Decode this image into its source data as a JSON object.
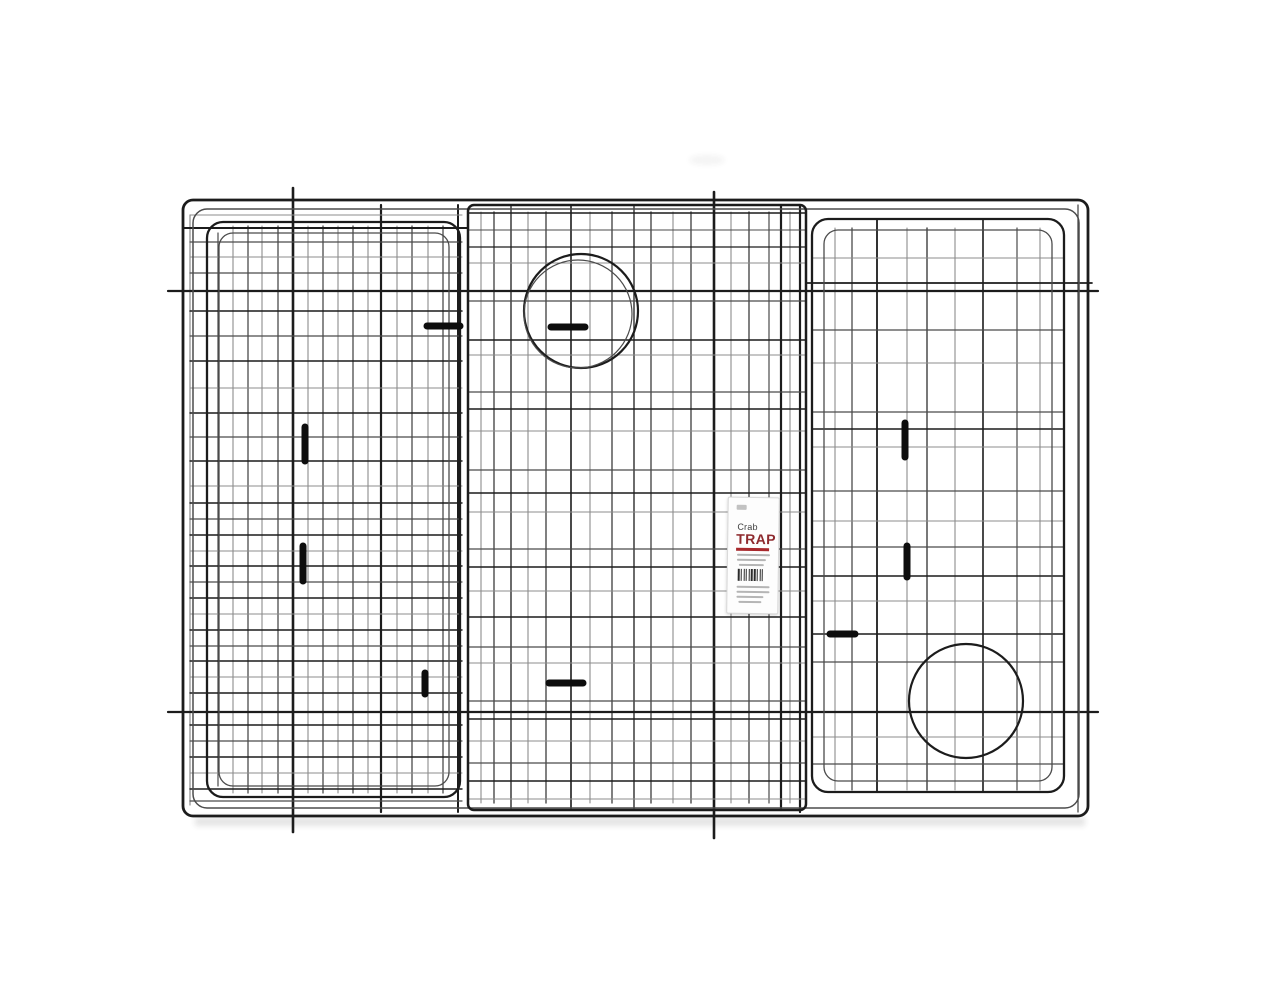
{
  "scene": {
    "description": "Black wire collapsible crab trap folded flat, viewed from the front on a plain white background",
    "background_color": "#ffffff"
  },
  "palette": {
    "wire_dark": "#1c1c1c",
    "wire_mid": "#4b4b4b",
    "wire_light": "#8c8c8c",
    "clip": "#0d0d0d",
    "label_red": "#a8282d",
    "label_title_color": "#8e2a2e",
    "shadow": "#2a2a2a"
  },
  "label": {
    "line1": "Crab",
    "line2": "TRAP",
    "barcode_pattern": "21121112112121121112",
    "gray_bars": [
      [
        9,
        56,
        33,
        2
      ],
      [
        9,
        61,
        29,
        2
      ],
      [
        11,
        66,
        25,
        2
      ],
      [
        9,
        88,
        33,
        2
      ],
      [
        9,
        93,
        33,
        2
      ],
      [
        9,
        98,
        27,
        2
      ],
      [
        11,
        103,
        23,
        2
      ]
    ]
  },
  "trap": {
    "width": 1280,
    "height": 989,
    "frames": [
      [
        183,
        200,
        905,
        616,
        10,
        2.8,
        "d"
      ],
      [
        193,
        209,
        886,
        599,
        14,
        1.5,
        "m"
      ],
      [
        207,
        222,
        253,
        575,
        16,
        2.3,
        "d"
      ],
      [
        219,
        233,
        230,
        553,
        14,
        1.3,
        "m"
      ],
      [
        468,
        205,
        338,
        605,
        6,
        2.5,
        "d"
      ],
      [
        812,
        219,
        252,
        573,
        16,
        2.3,
        "d"
      ],
      [
        824,
        230,
        228,
        551,
        14,
        1.3,
        "m"
      ]
    ],
    "v_wires": [
      [
        190,
        215,
        805,
        1.2,
        "l"
      ],
      [
        218,
        233,
        786,
        1.2,
        "m"
      ],
      [
        233,
        226,
        793,
        1.1,
        "l"
      ],
      [
        248,
        226,
        793,
        1.3,
        "m"
      ],
      [
        262,
        226,
        793,
        1.1,
        "l"
      ],
      [
        278,
        226,
        793,
        1.3,
        "m"
      ],
      [
        293,
        188,
        832,
        2.6,
        "d"
      ],
      [
        308,
        226,
        793,
        1.1,
        "l"
      ],
      [
        323,
        226,
        793,
        1.3,
        "m"
      ],
      [
        338,
        226,
        793,
        1.1,
        "l"
      ],
      [
        353,
        226,
        793,
        1.3,
        "m"
      ],
      [
        368,
        226,
        793,
        1.1,
        "l"
      ],
      [
        381,
        205,
        812,
        2.2,
        "d"
      ],
      [
        397,
        226,
        793,
        1.1,
        "l"
      ],
      [
        412,
        226,
        793,
        1.3,
        "m"
      ],
      [
        428,
        226,
        793,
        1.1,
        "l"
      ],
      [
        443,
        226,
        793,
        1.3,
        "m"
      ],
      [
        458,
        205,
        812,
        2.0,
        "d"
      ],
      [
        481,
        212,
        803,
        1.1,
        "l"
      ],
      [
        494,
        212,
        803,
        1.4,
        "m"
      ],
      [
        511,
        205,
        810,
        1.3,
        "d"
      ],
      [
        528,
        212,
        803,
        1.1,
        "l"
      ],
      [
        546,
        212,
        803,
        1.4,
        "m"
      ],
      [
        571,
        205,
        810,
        1.6,
        "d"
      ],
      [
        590,
        212,
        803,
        1.1,
        "l"
      ],
      [
        612,
        212,
        803,
        1.4,
        "m"
      ],
      [
        634,
        205,
        810,
        1.3,
        "d"
      ],
      [
        651,
        212,
        803,
        1.4,
        "m"
      ],
      [
        673,
        212,
        803,
        1.1,
        "l"
      ],
      [
        691,
        212,
        803,
        1.4,
        "m"
      ],
      [
        714,
        192,
        838,
        2.6,
        "d"
      ],
      [
        731,
        212,
        803,
        1.1,
        "l"
      ],
      [
        749,
        212,
        803,
        1.4,
        "m"
      ],
      [
        769,
        212,
        803,
        1.2,
        "m"
      ],
      [
        781,
        205,
        810,
        2.2,
        "d"
      ],
      [
        790,
        212,
        803,
        1.1,
        "l"
      ],
      [
        800,
        205,
        812,
        2.2,
        "d"
      ],
      [
        835,
        228,
        790,
        1.1,
        "l"
      ],
      [
        852,
        228,
        790,
        1.3,
        "m"
      ],
      [
        877,
        219,
        792,
        1.8,
        "d"
      ],
      [
        907,
        228,
        790,
        1.1,
        "l"
      ],
      [
        927,
        228,
        790,
        1.5,
        "m"
      ],
      [
        955,
        228,
        790,
        1.1,
        "l"
      ],
      [
        983,
        219,
        792,
        1.6,
        "d"
      ],
      [
        1017,
        228,
        790,
        1.2,
        "m"
      ],
      [
        1040,
        228,
        790,
        1.1,
        "l"
      ],
      [
        1078,
        205,
        812,
        1.3,
        "m"
      ]
    ],
    "h_wires": [
      [
        291,
        168,
        1098,
        2.2,
        "d"
      ],
      [
        712,
        168,
        1098,
        2.2,
        "d"
      ],
      [
        215,
        190,
        462,
        1.1,
        "l"
      ],
      [
        228,
        183,
        468,
        1.9,
        "d"
      ],
      [
        242,
        190,
        462,
        1.2,
        "m"
      ],
      [
        257,
        190,
        462,
        1.1,
        "l"
      ],
      [
        273,
        190,
        462,
        1.2,
        "m"
      ],
      [
        311,
        190,
        462,
        1.5,
        "d"
      ],
      [
        336,
        190,
        462,
        1.2,
        "m"
      ],
      [
        361,
        190,
        462,
        1.4,
        "d"
      ],
      [
        388,
        190,
        462,
        1.1,
        "l"
      ],
      [
        413,
        190,
        462,
        1.4,
        "d"
      ],
      [
        437,
        190,
        462,
        1.2,
        "m"
      ],
      [
        461,
        190,
        462,
        1.4,
        "d"
      ],
      [
        486,
        190,
        462,
        1.1,
        "l"
      ],
      [
        503,
        190,
        462,
        1.4,
        "d"
      ],
      [
        519,
        190,
        462,
        1.2,
        "m"
      ],
      [
        535,
        190,
        462,
        1.4,
        "d"
      ],
      [
        551,
        190,
        462,
        1.1,
        "l"
      ],
      [
        566,
        190,
        462,
        1.4,
        "d"
      ],
      [
        582,
        190,
        462,
        1.2,
        "m"
      ],
      [
        598,
        190,
        462,
        1.4,
        "d"
      ],
      [
        614,
        190,
        462,
        1.1,
        "l"
      ],
      [
        630,
        190,
        462,
        1.4,
        "d"
      ],
      [
        646,
        190,
        462,
        1.2,
        "m"
      ],
      [
        661,
        190,
        462,
        1.4,
        "d"
      ],
      [
        677,
        190,
        462,
        1.1,
        "l"
      ],
      [
        693,
        190,
        462,
        1.4,
        "d"
      ],
      [
        725,
        190,
        462,
        1.4,
        "d"
      ],
      [
        741,
        190,
        462,
        1.2,
        "m"
      ],
      [
        757,
        190,
        462,
        1.4,
        "d"
      ],
      [
        773,
        190,
        462,
        1.1,
        "l"
      ],
      [
        789,
        190,
        462,
        1.4,
        "d"
      ],
      [
        801,
        190,
        462,
        1.2,
        "m"
      ],
      [
        213,
        468,
        806,
        1.5,
        "d"
      ],
      [
        230,
        468,
        806,
        1.1,
        "m"
      ],
      [
        247,
        468,
        806,
        1.3,
        "d"
      ],
      [
        263,
        468,
        806,
        1.0,
        "l"
      ],
      [
        301,
        468,
        806,
        1.2,
        "m"
      ],
      [
        340,
        468,
        806,
        1.4,
        "d"
      ],
      [
        355,
        468,
        806,
        1.0,
        "l"
      ],
      [
        392,
        468,
        806,
        1.2,
        "m"
      ],
      [
        409,
        468,
        806,
        1.4,
        "d"
      ],
      [
        431,
        468,
        806,
        1.0,
        "l"
      ],
      [
        470,
        468,
        806,
        1.2,
        "m"
      ],
      [
        493,
        468,
        806,
        1.4,
        "d"
      ],
      [
        512,
        468,
        806,
        1.0,
        "l"
      ],
      [
        549,
        468,
        806,
        1.2,
        "m"
      ],
      [
        567,
        468,
        806,
        1.4,
        "d"
      ],
      [
        591,
        468,
        806,
        1.0,
        "l"
      ],
      [
        617,
        468,
        806,
        1.5,
        "d"
      ],
      [
        647,
        468,
        806,
        1.3,
        "m"
      ],
      [
        663,
        468,
        806,
        1.0,
        "l"
      ],
      [
        701,
        468,
        806,
        1.2,
        "m"
      ],
      [
        719,
        468,
        806,
        1.4,
        "d"
      ],
      [
        741,
        468,
        806,
        1.0,
        "l"
      ],
      [
        763,
        468,
        806,
        1.2,
        "m"
      ],
      [
        781,
        468,
        806,
        1.4,
        "d"
      ],
      [
        799,
        468,
        806,
        1.0,
        "l"
      ],
      [
        258,
        812,
        1064,
        1.1,
        "l"
      ],
      [
        283,
        806,
        1092,
        1.7,
        "d"
      ],
      [
        330,
        812,
        1064,
        1.2,
        "m"
      ],
      [
        363,
        812,
        1064,
        1.1,
        "l"
      ],
      [
        412,
        812,
        1064,
        1.2,
        "m"
      ],
      [
        429,
        812,
        1064,
        1.5,
        "d"
      ],
      [
        447,
        812,
        1064,
        1.1,
        "l"
      ],
      [
        491,
        812,
        1064,
        1.2,
        "m"
      ],
      [
        521,
        812,
        1064,
        1.1,
        "l"
      ],
      [
        547,
        812,
        1064,
        1.2,
        "m"
      ],
      [
        576,
        812,
        1064,
        1.5,
        "d"
      ],
      [
        601,
        812,
        1064,
        1.1,
        "l"
      ],
      [
        634,
        812,
        1064,
        1.5,
        "d"
      ],
      [
        662,
        812,
        1064,
        1.2,
        "m"
      ],
      [
        737,
        812,
        1064,
        1.1,
        "l"
      ],
      [
        764,
        812,
        1064,
        1.2,
        "m"
      ]
    ],
    "rings": [
      [
        581,
        311,
        57,
        2.2,
        "d"
      ],
      [
        578,
        314,
        54,
        1.2,
        "m"
      ],
      [
        966,
        701,
        57,
        2.2,
        "d"
      ]
    ],
    "clips": [
      [
        427,
        326,
        460,
        326
      ],
      [
        551,
        327,
        585,
        327
      ],
      [
        305,
        427,
        305,
        461
      ],
      [
        303,
        546,
        303,
        581
      ],
      [
        905,
        423,
        905,
        457
      ],
      [
        907,
        546,
        907,
        577
      ],
      [
        425,
        673,
        425,
        694
      ],
      [
        549,
        683,
        583,
        683
      ],
      [
        830,
        634,
        855,
        634
      ]
    ],
    "shadow": {
      "x": 195,
      "y": 817,
      "w": 890,
      "h": 9,
      "opacity": 0.12
    },
    "smudge": {
      "cx": 707,
      "cy": 160,
      "rx": 18,
      "ry": 5,
      "opacity": 0.05
    }
  }
}
